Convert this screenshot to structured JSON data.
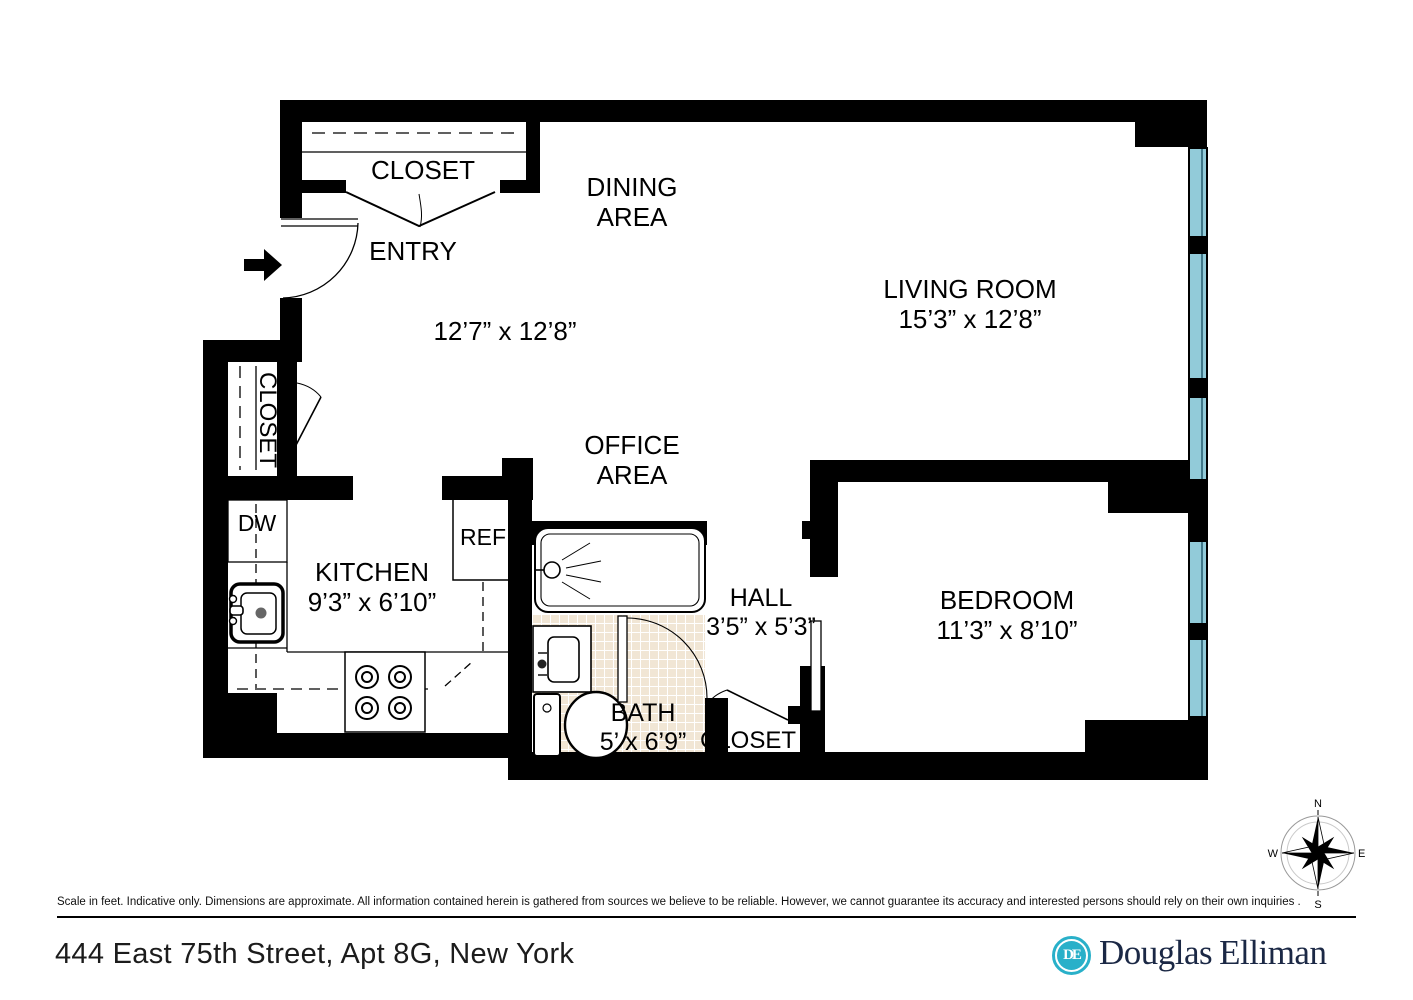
{
  "plan": {
    "entry_closet_label": "CLOSET",
    "side_closet_label": "CLOSET",
    "hall_closet_label": "CLOSET",
    "dining": {
      "line1": "DINING",
      "line2": "AREA"
    },
    "entry_label": "ENTRY",
    "entry_dining_dims": "12’7” x 12’8”",
    "living": {
      "name": "LIVING ROOM",
      "dims": "15’3” x 12’8”"
    },
    "office": {
      "line1": "OFFICE",
      "line2": "AREA"
    },
    "kitchen": {
      "name": "KITCHEN",
      "dims": "9’3” x 6’10”"
    },
    "appliances": {
      "dishwasher": "DW",
      "refrigerator": "REF"
    },
    "hall": {
      "name": "HALL",
      "dims": "3’5” x 5’3”"
    },
    "bath": {
      "name": "BATH",
      "dims": "5’ x 6’9”"
    },
    "bedroom": {
      "name": "BEDROOM",
      "dims": "11’3” x 8’10”"
    },
    "compass": {
      "north": "N",
      "south": "S",
      "east": "E",
      "west": "W"
    }
  },
  "footer": {
    "disclaimer": "Scale in feet. Indicative only. Dimensions are approximate. All information contained herein is gathered from sources we believe to be reliable. However, we cannot guarantee its accuracy and interested persons should rely on their own inquiries .",
    "address": "444 East 75th Street, Apt 8G, New York",
    "brand": {
      "monogram": "DE",
      "name_1": "Douglas",
      "name_2": "Elliman"
    }
  },
  "colors": {
    "window": "#92cbd9",
    "window_line": "#40788a",
    "tile": "#f1e6d5",
    "brand_cyan": "#29b0c9",
    "brand_navy": "#1b2845"
  }
}
